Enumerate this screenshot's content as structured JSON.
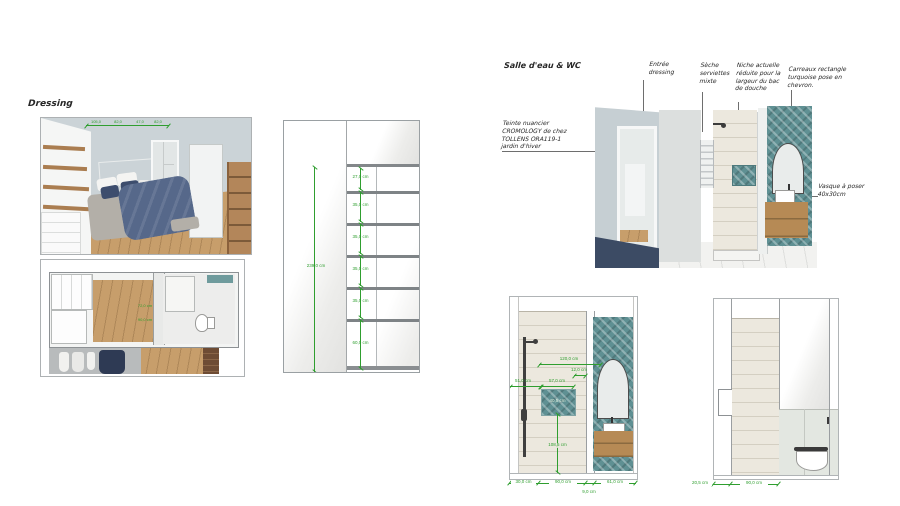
{
  "titles": {
    "dressing": "Dressing",
    "bathroom": "Salle d'eau & WC"
  },
  "annotations": {
    "paint": "Teinte nuancier\nCROMOLOGY  de chez\nTOLLENS ORA119-1\njardin d'hiver",
    "entry": "Entrée\ndressing",
    "towel": "Sèche\nserviettes\nmixte",
    "niche": "Niche actuelle\nréduite pour la\nlargeur du bac\nde douche",
    "tiles": "Carreaux rectangle\nturquoise pose en\nchevron.",
    "sink": "Vasque à poser\n40x30cm"
  },
  "wardrobe_elevation": {
    "total_height": "239,0 cm",
    "shelves": [
      "27,0 cm",
      "35,0 cm",
      "35,0 cm",
      "35,0 cm",
      "35,0 cm",
      "60,0 cm"
    ]
  },
  "bedroom_view": {
    "dims": [
      "105,0",
      "82,0",
      "47,0",
      "82,0"
    ]
  },
  "plan_view": {
    "dims": [
      "72,0 cm",
      "90,0 cm"
    ]
  },
  "shower_elevation": {
    "top_width": "120,0 cm",
    "gap": "12,0 cm",
    "left_offset": "51,0 cm",
    "niche_width": "57,0 cm",
    "niche_size": "40,5 cm",
    "height_below_niche": "108,5 cm",
    "bottom_left": "30,0 cm",
    "bottom_mid": "90,0 cm",
    "bottom_gap": "9,0 cm",
    "bottom_right": "61,0 cm"
  },
  "wc_elevation": {
    "bottom_left": "20,5 cm",
    "bottom_mid": "90,0 cm"
  },
  "colors": {
    "dimension_green": "#2f9e2f",
    "turquoise_tile": "#5f9093",
    "wood": "#c79e6b",
    "vanity_wood": "#b68a55",
    "wall_blue_gray": "#ccd4d8",
    "navy_textile": "#3d4d6d"
  }
}
